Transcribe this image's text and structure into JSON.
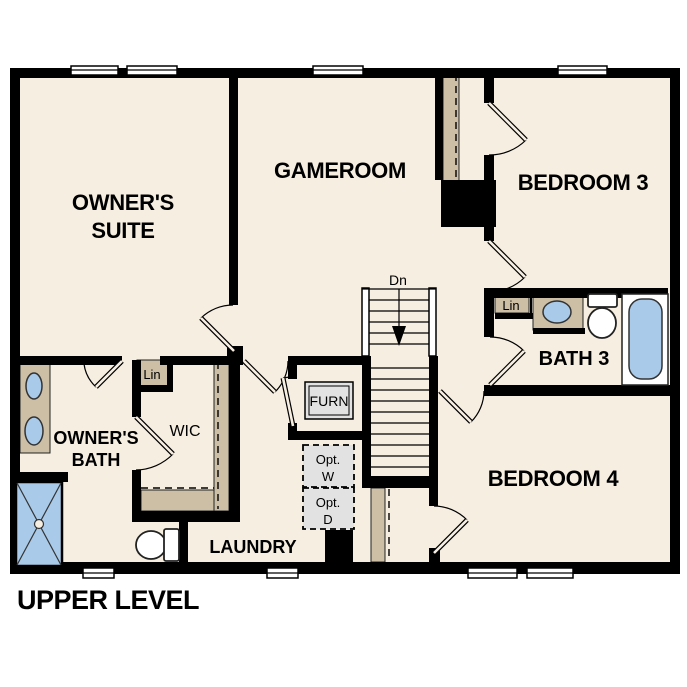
{
  "title": "UPPER LEVEL",
  "rooms": {
    "owners_suite_line1": "OWNER'S",
    "owners_suite_line2": "SUITE",
    "gameroom": "GAMEROOM",
    "bedroom3": "BEDROOM 3",
    "bedroom4": "BEDROOM 4",
    "bath3": "BATH 3",
    "owners_bath_line1": "OWNER'S",
    "owners_bath_line2": "BATH",
    "laundry": "LAUNDRY",
    "wic": "WIC"
  },
  "closets": {
    "lin_wic": "Lin",
    "lin_bath3": "Lin"
  },
  "stairs": {
    "down_label": "Dn"
  },
  "equipment": {
    "furnace": "FURN",
    "opt_washer_line1": "Opt.",
    "opt_washer_line2": "W",
    "opt_dryer_line1": "Opt.",
    "opt_dryer_line2": "D"
  },
  "colors": {
    "background": "#FFFFFF",
    "floor": "#F6EEE1",
    "wall": "#000000",
    "casework_tan": "#CCBFA6",
    "fixture_blue": "#A9CAE8",
    "optional_gray": "#E2E2E2"
  }
}
